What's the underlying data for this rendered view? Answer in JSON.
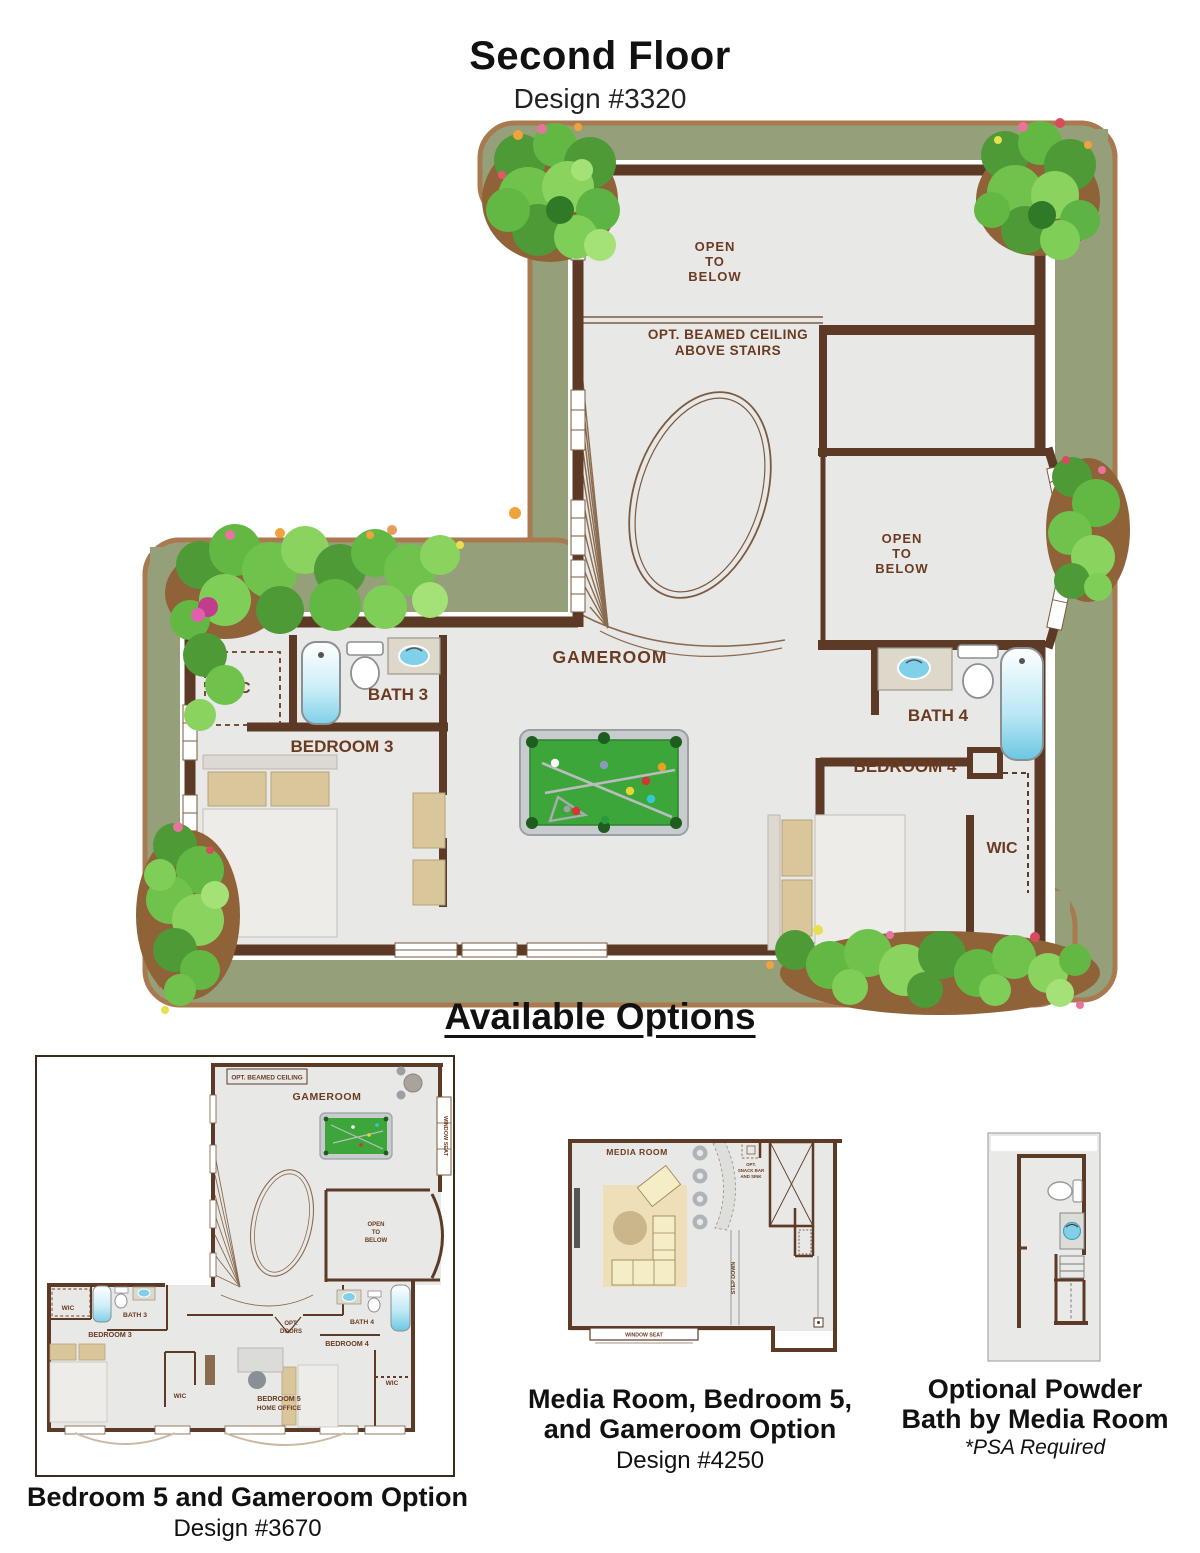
{
  "header": {
    "title": "Second Floor",
    "design": "Design #3320"
  },
  "sections": {
    "available_options": "Available Options"
  },
  "main_plan": {
    "labels": {
      "open_to_below_top": [
        "OPEN",
        "TO",
        "BELOW"
      ],
      "beamed_ceiling": [
        "OPT. BEAMED CEILING",
        "ABOVE STAIRS"
      ],
      "open_to_below_right": [
        "OPEN",
        "TO",
        "BELOW"
      ],
      "gameroom": "GAMEROOM",
      "wic_left": "WIC",
      "bath3": "BATH 3",
      "bedroom3": "BEDROOM 3",
      "bath4": "BATH 4",
      "bedroom4": "BEDROOM 4",
      "wic_right": "WIC"
    }
  },
  "option1": {
    "labels": {
      "opt_beamed_ceiling": "OPT. BEAMED CEILING",
      "gameroom": "GAMEROOM",
      "window_seat": "WINDOW SEAT",
      "open_to_below": [
        "OPEN",
        "TO",
        "BELOW"
      ],
      "wic_left": "WIC",
      "bath3": "BATH 3",
      "bedroom3": "BEDROOM 3",
      "opt_doors": [
        "OPT.",
        "DOORS"
      ],
      "wic_mid": "WIC",
      "bedroom5": [
        "BEDROOM 5",
        "HOME OFFICE"
      ],
      "bath4": "BATH 4",
      "bedroom4": "BEDROOM 4",
      "wic_right": "WIC"
    },
    "caption": "Bedroom 5 and Gameroom Option",
    "design": "Design #3670"
  },
  "option2": {
    "labels": {
      "media_room": "MEDIA ROOM",
      "snack_bar": [
        "OPT.",
        "SNACK BAR",
        "AND SINK"
      ],
      "step_down": "STEP DOWN",
      "window_seat": "WINDOW SEAT"
    },
    "caption": [
      "Media Room, Bedroom 5,",
      "and Gameroom Option"
    ],
    "design": "Design #4250"
  },
  "option3": {
    "caption": [
      "Optional Powder",
      "Bath by Media Room"
    ],
    "note": "*PSA Required"
  },
  "colors": {
    "wall_brown": "#5C3A26",
    "label_brown": "#6B3B21",
    "floor_gray": "#E8E8E6",
    "landscape_sage": "#95A07A",
    "landscape_edge": "#A97A4F",
    "tree_green": "#63B844",
    "ground_brown": "#8F6238",
    "pool_felt": "#3DA63B",
    "water_blue": "#7FD0E8",
    "counter_beige": "#DDD8C9",
    "furniture_tan": "#D9C69B"
  }
}
